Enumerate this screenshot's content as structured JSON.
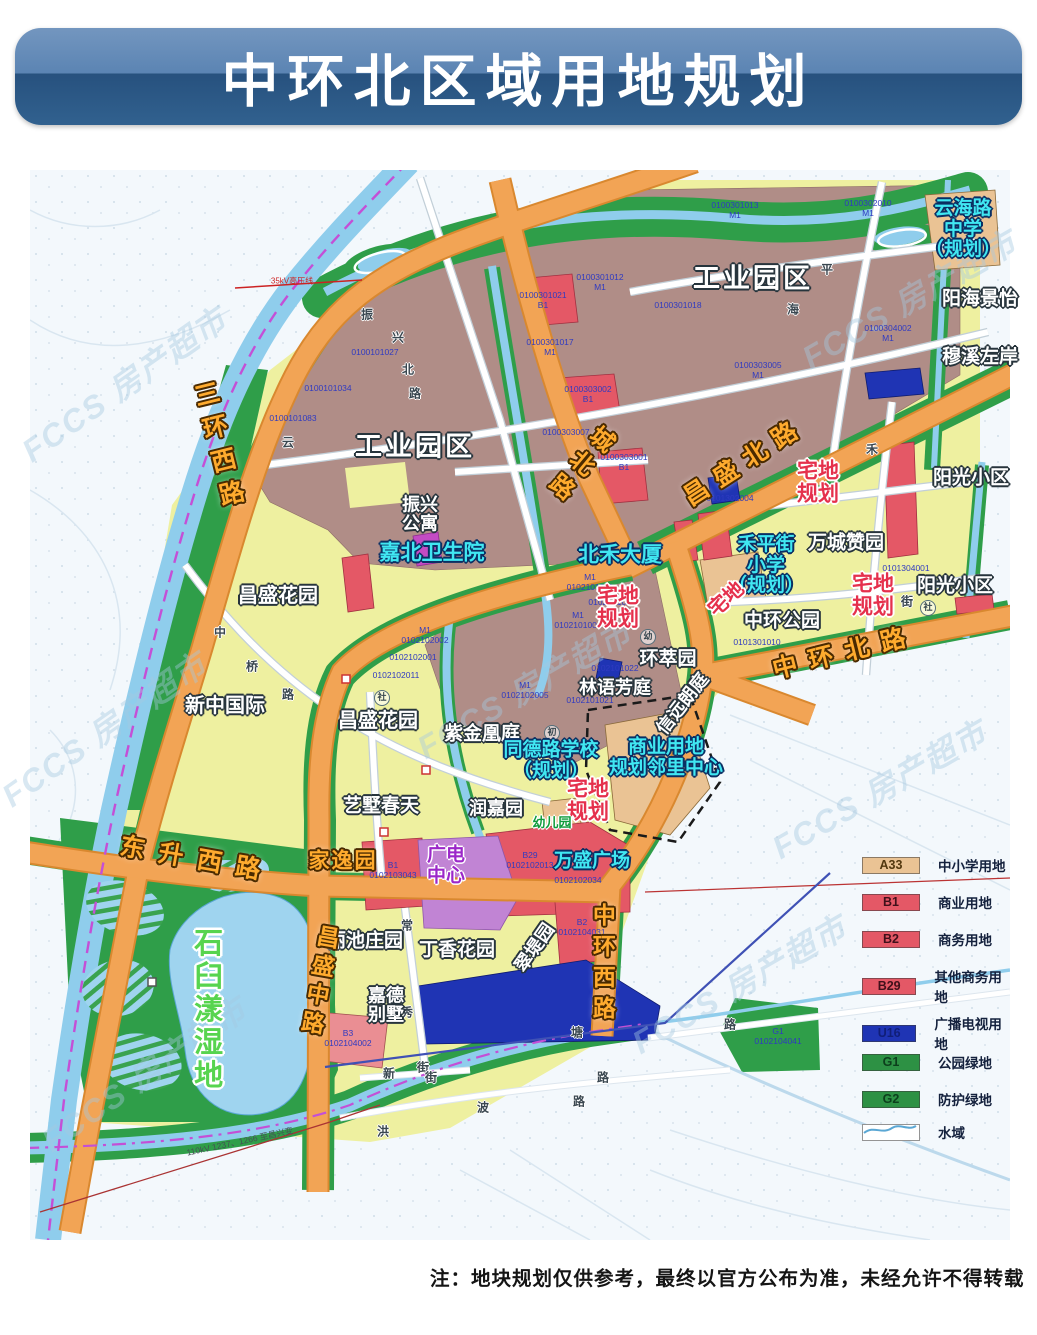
{
  "title": "中环北区域用地规划",
  "note": "注：地块规划仅供参考，最终以官方公布为准，未经允许不得转载",
  "watermark_text": "FCCS 房产超市",
  "colors": {
    "banner_top": "#5b84b3",
    "banner_bottom": "#27517e",
    "industrial": "#b08d87",
    "residential_yellow": "#eef0a0",
    "green": "#2f9e49",
    "road_orange": "#f2a455",
    "water": "#8fcdec",
    "red_parcel": "#e45866",
    "u16_blue": "#1f34b4",
    "a33_tan": "#eac394",
    "purple_parcel": "#c184d4",
    "dash_magenta": "#c44fd6"
  },
  "legend": {
    "items": [
      {
        "code": "A33",
        "label": "中小学用地",
        "fill": "#eac394",
        "text_color": "#53380f"
      },
      {
        "code": "B1",
        "label": "商业用地",
        "fill": "#e45866",
        "text_color": "#40101a"
      },
      {
        "code": "B2",
        "label": "商务用地",
        "fill": "#e45866",
        "text_color": "#40101a"
      },
      {
        "code": "B29",
        "label": "其他商务用地",
        "fill": "#e45866",
        "text_color": "#40101a"
      },
      {
        "code": "U16",
        "label": "广播电视用地",
        "fill": "#1f34b4",
        "text_color": "#101e78"
      },
      {
        "code": "G1",
        "label": "公园绿地",
        "fill": "#2d9144",
        "text_color": "#0c3f1c"
      },
      {
        "code": "G2",
        "label": "防护绿地",
        "fill": "#2d9144",
        "text_color": "#0c3f1c"
      },
      {
        "code": "",
        "label": "水域",
        "fill": "water",
        "text_color": "#14213d"
      }
    ]
  },
  "map": {
    "watermarks": [
      {
        "x": 95,
        "y": 215,
        "rot": -35
      },
      {
        "x": 75,
        "y": 560,
        "rot": -35
      },
      {
        "x": 115,
        "y": 905,
        "rot": -35
      },
      {
        "x": 495,
        "y": 520,
        "rot": -30
      },
      {
        "x": 710,
        "y": 815,
        "rot": -30
      },
      {
        "x": 880,
        "y": 130,
        "rot": -30
      },
      {
        "x": 850,
        "y": 620,
        "rot": -30
      }
    ],
    "labels": [
      {
        "lines": [
          "0100301013",
          "M1"
        ],
        "x": 705,
        "y": 40,
        "cls": "parcel"
      },
      {
        "lines": [
          "0100302010",
          "M1"
        ],
        "x": 838,
        "y": 38,
        "cls": "parcel"
      },
      {
        "lines": [
          "0100301012",
          "M1"
        ],
        "x": 570,
        "y": 112,
        "cls": "parcel"
      },
      {
        "lines": [
          "0100301018"
        ],
        "x": 648,
        "y": 135,
        "cls": "parcel"
      },
      {
        "lines": [
          "0100301017",
          "M1"
        ],
        "x": 520,
        "y": 177,
        "cls": "parcel"
      },
      {
        "lines": [
          "0100301021",
          "B1"
        ],
        "x": 513,
        "y": 130,
        "cls": "parcel"
      },
      {
        "lines": [
          "0100303005",
          "M1"
        ],
        "x": 728,
        "y": 200,
        "cls": "parcel"
      },
      {
        "lines": [
          "0100304002",
          "M1"
        ],
        "x": 858,
        "y": 163,
        "cls": "parcel"
      },
      {
        "lines": [
          "0100303002",
          "B1"
        ],
        "x": 558,
        "y": 224,
        "cls": "parcel"
      },
      {
        "lines": [
          "0100303001",
          "B1"
        ],
        "x": 594,
        "y": 292,
        "cls": "parcel"
      },
      {
        "lines": [
          "0100303007"
        ],
        "x": 536,
        "y": 262,
        "cls": "parcel"
      },
      {
        "lines": [
          "0100101027"
        ],
        "x": 345,
        "y": 182,
        "cls": "parcel"
      },
      {
        "lines": [
          "0100101034"
        ],
        "x": 298,
        "y": 218,
        "cls": "parcel"
      },
      {
        "lines": [
          "0100101083"
        ],
        "x": 263,
        "y": 248,
        "cls": "parcel"
      },
      {
        "lines": [
          "M1",
          "0102101011"
        ],
        "x": 560,
        "y": 412,
        "cls": "parcel"
      },
      {
        "lines": [
          "0102101012"
        ],
        "x": 582,
        "y": 432,
        "cls": "parcel"
      },
      {
        "lines": [
          "M1",
          "0102101001"
        ],
        "x": 548,
        "y": 450,
        "cls": "parcel"
      },
      {
        "lines": [
          "M1",
          "0102102002"
        ],
        "x": 395,
        "y": 465,
        "cls": "parcel"
      },
      {
        "lines": [
          "0102102001"
        ],
        "x": 383,
        "y": 487,
        "cls": "parcel"
      },
      {
        "lines": [
          "0102102011"
        ],
        "x": 366,
        "y": 505,
        "cls": "parcel"
      },
      {
        "lines": [
          "M1",
          "0102102005"
        ],
        "x": 495,
        "y": 520,
        "cls": "parcel"
      },
      {
        "lines": [
          "0102101021"
        ],
        "x": 560,
        "y": 530,
        "cls": "parcel"
      },
      {
        "lines": [
          "0102101022"
        ],
        "x": 585,
        "y": 498,
        "cls": "parcel"
      },
      {
        "lines": [
          "0101302004"
        ],
        "x": 700,
        "y": 328,
        "cls": "parcel"
      },
      {
        "lines": [
          "0101304001"
        ],
        "x": 876,
        "y": 398,
        "cls": "parcel"
      },
      {
        "lines": [
          "0101301010"
        ],
        "x": 727,
        "y": 472,
        "cls": "parcel"
      },
      {
        "lines": [
          "B1",
          "0102103043"
        ],
        "x": 363,
        "y": 700,
        "cls": "parcel"
      },
      {
        "lines": [
          "B29",
          "0102102013"
        ],
        "x": 500,
        "y": 690,
        "cls": "parcel"
      },
      {
        "lines": [
          "0102102034"
        ],
        "x": 548,
        "y": 710,
        "cls": "parcel"
      },
      {
        "lines": [
          "B2",
          "0102104031"
        ],
        "x": 552,
        "y": 757,
        "cls": "parcel"
      },
      {
        "lines": [
          "G1",
          "0102104041"
        ],
        "x": 748,
        "y": 866,
        "cls": "parcel"
      },
      {
        "lines": [
          "B3",
          "0102104002"
        ],
        "x": 318,
        "y": 868,
        "cls": "parcel"
      },
      {
        "t": "振",
        "x": 337,
        "y": 145,
        "cls": "street"
      },
      {
        "t": "兴",
        "x": 368,
        "y": 168,
        "cls": "street"
      },
      {
        "t": "北",
        "x": 378,
        "y": 200,
        "cls": "street"
      },
      {
        "t": "路",
        "x": 385,
        "y": 224,
        "cls": "street"
      },
      {
        "t": "云",
        "x": 258,
        "y": 273,
        "cls": "street"
      },
      {
        "t": "海",
        "x": 763,
        "y": 140,
        "cls": "street"
      },
      {
        "t": "平",
        "x": 797,
        "y": 100,
        "cls": "street"
      },
      {
        "t": "禾",
        "x": 842,
        "y": 280,
        "cls": "street"
      },
      {
        "t": "街",
        "x": 877,
        "y": 432,
        "cls": "street"
      },
      {
        "t": "中",
        "x": 190,
        "y": 463,
        "cls": "street"
      },
      {
        "t": "桥",
        "x": 222,
        "y": 497,
        "cls": "street"
      },
      {
        "t": "路",
        "x": 258,
        "y": 525,
        "cls": "street"
      },
      {
        "t": "常",
        "x": 377,
        "y": 756,
        "cls": "street"
      },
      {
        "t": "秀",
        "x": 377,
        "y": 843,
        "cls": "street"
      },
      {
        "t": "街",
        "x": 393,
        "y": 898,
        "cls": "street"
      },
      {
        "t": "新",
        "x": 359,
        "y": 904,
        "cls": "street"
      },
      {
        "t": "街",
        "x": 401,
        "y": 908,
        "cls": "street"
      },
      {
        "t": "洪",
        "x": 353,
        "y": 962,
        "cls": "street"
      },
      {
        "t": "波",
        "x": 453,
        "y": 938,
        "cls": "street"
      },
      {
        "t": "路",
        "x": 549,
        "y": 932,
        "cls": "street"
      },
      {
        "t": "路",
        "x": 573,
        "y": 908,
        "cls": "street"
      },
      {
        "t": "塘",
        "x": 547,
        "y": 863,
        "cls": "street"
      },
      {
        "t": "路",
        "x": 700,
        "y": 855,
        "cls": "street"
      },
      {
        "t": "社",
        "x": 352,
        "y": 528,
        "cls": "circled"
      },
      {
        "t": "社",
        "x": 898,
        "y": 438,
        "cls": "circled"
      },
      {
        "t": "幼",
        "x": 618,
        "y": 467,
        "cls": "circled"
      },
      {
        "t": "初",
        "x": 522,
        "y": 563,
        "cls": "circled"
      },
      {
        "t": "35kV高压线",
        "x": 262,
        "y": 112,
        "cls": "tinyred"
      },
      {
        "t": "110kV 1237、1266 至昌兴变",
        "x": 210,
        "y": 972,
        "cls": "tinydark",
        "rot": -12
      },
      {
        "t": "工业园区",
        "x": 385,
        "y": 277,
        "cls": "place",
        "fs": 27,
        "ls": 3
      },
      {
        "t": "工业园区",
        "x": 723,
        "y": 109,
        "cls": "place",
        "fs": 27,
        "ls": 3
      },
      {
        "lines": [
          "振兴",
          "公寓"
        ],
        "x": 390,
        "y": 345,
        "cls": "place",
        "fs": 18
      },
      {
        "t": "昌盛花园",
        "x": 248,
        "y": 427,
        "cls": "place",
        "fs": 20
      },
      {
        "t": "昌盛花园",
        "x": 348,
        "y": 552,
        "cls": "place",
        "fs": 20
      },
      {
        "t": "新中国际",
        "x": 195,
        "y": 537,
        "cls": "place",
        "fs": 20
      },
      {
        "t": "阳海景怡",
        "x": 950,
        "y": 130,
        "cls": "place",
        "fs": 19
      },
      {
        "t": "穆溪左岸",
        "x": 950,
        "y": 188,
        "cls": "place",
        "fs": 19
      },
      {
        "t": "阳光小区",
        "x": 941,
        "y": 309,
        "cls": "place",
        "fs": 19
      },
      {
        "t": "阳光小区",
        "x": 925,
        "y": 417,
        "cls": "place",
        "fs": 19
      },
      {
        "t": "万城赞园",
        "x": 816,
        "y": 374,
        "cls": "place",
        "fs": 19
      },
      {
        "t": "中环公园",
        "x": 752,
        "y": 452,
        "cls": "place",
        "fs": 19
      },
      {
        "t": "环萃园",
        "x": 638,
        "y": 490,
        "cls": "place",
        "fs": 19
      },
      {
        "t": "林语芳庭",
        "x": 585,
        "y": 518,
        "cls": "place",
        "fs": 18
      },
      {
        "t": "信远朗庭",
        "x": 653,
        "y": 534,
        "cls": "place",
        "fs": 18,
        "rot": -52
      },
      {
        "t": "紫金凰庭",
        "x": 452,
        "y": 565,
        "cls": "place",
        "fs": 19
      },
      {
        "t": "艺墅春天",
        "x": 351,
        "y": 637,
        "cls": "place",
        "fs": 19
      },
      {
        "t": "润嘉园",
        "x": 466,
        "y": 639,
        "cls": "place",
        "fs": 18
      },
      {
        "t": "丽池庄园",
        "x": 335,
        "y": 772,
        "cls": "place",
        "fs": 19
      },
      {
        "t": "丁香花园",
        "x": 427,
        "y": 781,
        "cls": "place",
        "fs": 19
      },
      {
        "t": "翠堤园",
        "x": 505,
        "y": 778,
        "cls": "place",
        "fs": 18,
        "rot": -55
      },
      {
        "lines": [
          "嘉德",
          "别墅"
        ],
        "x": 356,
        "y": 836,
        "cls": "place",
        "fs": 18
      },
      {
        "t": "嘉北卫生院",
        "x": 402,
        "y": 384,
        "cls": "cyan",
        "fs": 21
      },
      {
        "t": "北禾大厦",
        "x": 590,
        "y": 386,
        "cls": "cyan",
        "fs": 21
      },
      {
        "lines": [
          "云海路",
          "中学",
          "（规划）"
        ],
        "x": 933,
        "y": 60,
        "cls": "cyan",
        "fs": 19
      },
      {
        "lines": [
          "禾平街",
          "小学",
          "（规划）"
        ],
        "x": 736,
        "y": 396,
        "cls": "cyan",
        "fs": 19
      },
      {
        "lines": [
          "同德路学校",
          "（规划）"
        ],
        "x": 521,
        "y": 591,
        "cls": "cyan",
        "fs": 19
      },
      {
        "lines": [
          "商业用地",
          "规划邻里中心"
        ],
        "x": 636,
        "y": 588,
        "cls": "cyan",
        "fs": 19
      },
      {
        "t": "万盛广场",
        "x": 562,
        "y": 692,
        "cls": "cyan",
        "fs": 19
      },
      {
        "lines": [
          "宅地",
          "规划"
        ],
        "x": 588,
        "y": 438,
        "cls": "redlbl",
        "fs": 21
      },
      {
        "lines": [
          "宅地",
          "规划"
        ],
        "x": 788,
        "y": 313,
        "cls": "redlbl",
        "fs": 21
      },
      {
        "lines": [
          "宅地",
          "规划"
        ],
        "x": 843,
        "y": 426,
        "cls": "redlbl",
        "fs": 21
      },
      {
        "lines": [
          "宅地",
          "规划"
        ],
        "x": 558,
        "y": 631,
        "cls": "redlbl",
        "fs": 21
      },
      {
        "t": "宅地",
        "x": 697,
        "y": 430,
        "cls": "redlbl",
        "fs": 20,
        "rot": -42
      },
      {
        "t": "石臼漾湿地",
        "x": 175,
        "y": 840,
        "cls": "greenbig vert",
        "fs": 29,
        "ls": 4
      },
      {
        "t": "幼儿园",
        "x": 522,
        "y": 653,
        "cls": "greensm",
        "fs": 13
      },
      {
        "lines": [
          "广电",
          "中心"
        ],
        "x": 416,
        "y": 696,
        "cls": "purplelbl",
        "fs": 19
      },
      {
        "t": "三环西路",
        "x": 188,
        "y": 278,
        "cls": "roadlbl vert",
        "fs": 25,
        "ls": 9,
        "rot": -14
      },
      {
        "t": "城北路",
        "x": 548,
        "y": 293,
        "cls": "roadlbl vert",
        "fs": 24,
        "ls": 7,
        "rot": 40
      },
      {
        "t": "昌盛北路",
        "x": 715,
        "y": 292,
        "cls": "roadlbl",
        "fs": 25,
        "ls": 10,
        "rot": -33
      },
      {
        "t": "中环北路",
        "x": 815,
        "y": 483,
        "cls": "roadlbl",
        "fs": 25,
        "ls": 12,
        "rot": -14
      },
      {
        "t": "东升西路",
        "x": 167,
        "y": 690,
        "cls": "roadlbl",
        "fs": 25,
        "ls": 14,
        "rot": 10
      },
      {
        "t": "昌盛中路",
        "x": 288,
        "y": 812,
        "cls": "roadlbl vert",
        "fs": 23,
        "ls": 6,
        "rot": 10
      },
      {
        "t": "中环西路",
        "x": 572,
        "y": 795,
        "cls": "roadlbl vert",
        "fs": 23,
        "ls": 8
      },
      {
        "t": "家逸园",
        "x": 313,
        "y": 692,
        "cls": "roadlbl",
        "fs": 21,
        "ls": 2
      }
    ]
  }
}
